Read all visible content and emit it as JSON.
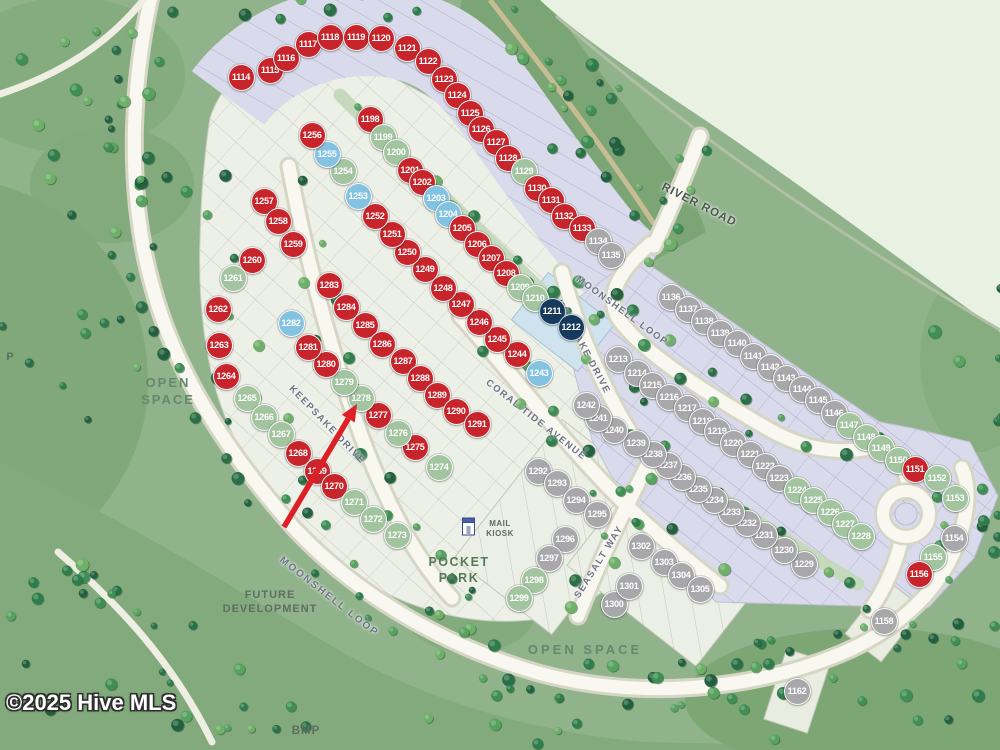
{
  "watermark": "©2025 Hive MLS",
  "map": {
    "status_colors": {
      "r": "#c7252b",
      "g": "#a2c5a0",
      "b": "#84c2e2",
      "n": "#16395c",
      "y": "#a8a8ab"
    },
    "street_labels": [
      {
        "id": "river-road",
        "text": "RIVER ROAD",
        "x": 699,
        "y": 205,
        "rot": 27,
        "size": 11.5,
        "ls": 1,
        "color": "#4c564c"
      },
      {
        "id": "moonshell-loop-ne",
        "text": "MOONSHELL LOOP",
        "x": 622,
        "y": 311,
        "rot": 36,
        "size": 9.5,
        "ls": 1.5,
        "color": "#6e7386"
      },
      {
        "id": "moonshell-loop-sw",
        "text": "MOONSHELL LOOP",
        "x": 329,
        "y": 597,
        "rot": 38,
        "size": 10,
        "ls": 2,
        "color": "#6e7386"
      },
      {
        "id": "keepsake-drive-e",
        "text": "KEEPSAKE DRIVE",
        "x": 583,
        "y": 347,
        "rot": 62,
        "size": 9.5,
        "ls": 1.5,
        "color": "#6e7386"
      },
      {
        "id": "keepsake-drive-w",
        "text": "KEEPSAKE DRIVE",
        "x": 327,
        "y": 425,
        "rot": 46,
        "size": 9.5,
        "ls": 1.5,
        "color": "#6e7386"
      },
      {
        "id": "coral-tide-avenue",
        "text": "CORAL TIDE AVENUE",
        "x": 536,
        "y": 420,
        "rot": 38,
        "size": 9.5,
        "ls": 1.5,
        "color": "#6e7386"
      },
      {
        "id": "seasalt-way",
        "text": "SEASALT WAY",
        "x": 599,
        "y": 562,
        "rot": -58,
        "size": 9.5,
        "ls": 1.5,
        "color": "#6e7386"
      }
    ],
    "area_labels": [
      {
        "id": "open-space-left",
        "lines": [
          "OPEN",
          "SPACE"
        ],
        "x": 168,
        "y": 375,
        "size": 13,
        "ls": 2,
        "color": "#66876b"
      },
      {
        "id": "open-space-bottom",
        "lines": [
          "OPEN SPACE"
        ],
        "x": 585,
        "y": 642,
        "size": 13,
        "ls": 3,
        "color": "#66876b"
      },
      {
        "id": "future-development",
        "lines": [
          "FUTURE",
          "DEVELOPMENT"
        ],
        "x": 270,
        "y": 588,
        "size": 11,
        "ls": 1,
        "color": "#5e6e60"
      },
      {
        "id": "pocket-park",
        "lines": [
          "POCKET",
          "PARK"
        ],
        "x": 459,
        "y": 554,
        "size": 12.5,
        "ls": 1.5,
        "color": "#567a58"
      },
      {
        "id": "bmp",
        "lines": [
          "BMP"
        ],
        "x": 306,
        "y": 724,
        "size": 11.5,
        "ls": 1,
        "color": "#5e6e60"
      },
      {
        "id": "p-partial",
        "lines": [
          "P"
        ],
        "x": 10,
        "y": 350,
        "size": 11,
        "ls": 0,
        "color": "#5e6e60"
      },
      {
        "id": "mail-kiosk",
        "lines": [
          "MAIL",
          "KIOSK"
        ],
        "x": 500,
        "y": 519,
        "size": 8,
        "ls": 0.5,
        "color": "#5c6c66"
      }
    ],
    "annotations": {
      "arrow": {
        "x1": 284,
        "y1": 527,
        "x2": 357,
        "y2": 404,
        "color": "#dd1f26"
      }
    },
    "lots": [
      {
        "n": "1114",
        "x": 241,
        "y": 77,
        "c": "r"
      },
      {
        "n": "1115",
        "x": 270,
        "y": 70,
        "c": "r"
      },
      {
        "n": "1116",
        "x": 286,
        "y": 58,
        "c": "r"
      },
      {
        "n": "1117",
        "x": 308,
        "y": 44,
        "c": "r"
      },
      {
        "n": "1118",
        "x": 330,
        "y": 37,
        "c": "r"
      },
      {
        "n": "1119",
        "x": 356,
        "y": 37,
        "c": "r"
      },
      {
        "n": "1120",
        "x": 381,
        "y": 38,
        "c": "r"
      },
      {
        "n": "1121",
        "x": 407,
        "y": 48,
        "c": "r"
      },
      {
        "n": "1122",
        "x": 428,
        "y": 61,
        "c": "r"
      },
      {
        "n": "1123",
        "x": 444,
        "y": 79,
        "c": "r"
      },
      {
        "n": "1124",
        "x": 457,
        "y": 95,
        "c": "r"
      },
      {
        "n": "1125",
        "x": 470,
        "y": 113,
        "c": "r"
      },
      {
        "n": "1126",
        "x": 481,
        "y": 129,
        "c": "r"
      },
      {
        "n": "1127",
        "x": 496,
        "y": 142,
        "c": "r"
      },
      {
        "n": "1128",
        "x": 508,
        "y": 158,
        "c": "r"
      },
      {
        "n": "1129",
        "x": 524,
        "y": 171,
        "c": "g"
      },
      {
        "n": "1130",
        "x": 537,
        "y": 188,
        "c": "r"
      },
      {
        "n": "1131",
        "x": 551,
        "y": 200,
        "c": "r"
      },
      {
        "n": "1132",
        "x": 564,
        "y": 216,
        "c": "r"
      },
      {
        "n": "1133",
        "x": 582,
        "y": 228,
        "c": "r"
      },
      {
        "n": "1134",
        "x": 598,
        "y": 241,
        "c": "y"
      },
      {
        "n": "1135",
        "x": 611,
        "y": 255,
        "c": "y"
      },
      {
        "n": "1136",
        "x": 671,
        "y": 297,
        "c": "y"
      },
      {
        "n": "1137",
        "x": 688,
        "y": 309,
        "c": "y"
      },
      {
        "n": "1138",
        "x": 704,
        "y": 321,
        "c": "y"
      },
      {
        "n": "1139",
        "x": 720,
        "y": 333,
        "c": "y"
      },
      {
        "n": "1140",
        "x": 737,
        "y": 343,
        "c": "y"
      },
      {
        "n": "1141",
        "x": 753,
        "y": 356,
        "c": "y"
      },
      {
        "n": "1142",
        "x": 770,
        "y": 367,
        "c": "y"
      },
      {
        "n": "1143",
        "x": 786,
        "y": 378,
        "c": "y"
      },
      {
        "n": "1144",
        "x": 802,
        "y": 389,
        "c": "y"
      },
      {
        "n": "1145",
        "x": 818,
        "y": 400,
        "c": "y"
      },
      {
        "n": "1146",
        "x": 834,
        "y": 413,
        "c": "y"
      },
      {
        "n": "1147",
        "x": 849,
        "y": 425,
        "c": "g"
      },
      {
        "n": "1148",
        "x": 866,
        "y": 437,
        "c": "g"
      },
      {
        "n": "1149",
        "x": 881,
        "y": 448,
        "c": "g"
      },
      {
        "n": "1150",
        "x": 898,
        "y": 460,
        "c": "g"
      },
      {
        "n": "1151",
        "x": 915,
        "y": 469,
        "c": "r"
      },
      {
        "n": "1152",
        "x": 937,
        "y": 478,
        "c": "g"
      },
      {
        "n": "1153",
        "x": 955,
        "y": 498,
        "c": "g"
      },
      {
        "n": "1154",
        "x": 954,
        "y": 538,
        "c": "y"
      },
      {
        "n": "1155",
        "x": 933,
        "y": 557,
        "c": "g"
      },
      {
        "n": "1156",
        "x": 919,
        "y": 574,
        "c": "r"
      },
      {
        "n": "1158",
        "x": 884,
        "y": 621,
        "c": "y"
      },
      {
        "n": "1162",
        "x": 797,
        "y": 691,
        "c": "y"
      },
      {
        "n": "1198",
        "x": 370,
        "y": 119,
        "c": "r"
      },
      {
        "n": "1199",
        "x": 383,
        "y": 137,
        "c": "g"
      },
      {
        "n": "1200",
        "x": 396,
        "y": 152,
        "c": "g"
      },
      {
        "n": "1201",
        "x": 410,
        "y": 170,
        "c": "r"
      },
      {
        "n": "1202",
        "x": 422,
        "y": 182,
        "c": "r"
      },
      {
        "n": "1203",
        "x": 436,
        "y": 198,
        "c": "b"
      },
      {
        "n": "1204",
        "x": 448,
        "y": 214,
        "c": "b"
      },
      {
        "n": "1205",
        "x": 462,
        "y": 228,
        "c": "r"
      },
      {
        "n": "1206",
        "x": 477,
        "y": 244,
        "c": "r"
      },
      {
        "n": "1207",
        "x": 491,
        "y": 258,
        "c": "r"
      },
      {
        "n": "1208",
        "x": 506,
        "y": 273,
        "c": "r"
      },
      {
        "n": "1209",
        "x": 520,
        "y": 287,
        "c": "g"
      },
      {
        "n": "1210",
        "x": 535,
        "y": 298,
        "c": "g"
      },
      {
        "n": "1211",
        "x": 552,
        "y": 311,
        "c": "n"
      },
      {
        "n": "1212",
        "x": 571,
        "y": 327,
        "c": "n"
      },
      {
        "n": "1213",
        "x": 618,
        "y": 359,
        "c": "y"
      },
      {
        "n": "1214",
        "x": 637,
        "y": 373,
        "c": "y"
      },
      {
        "n": "1215",
        "x": 652,
        "y": 385,
        "c": "y"
      },
      {
        "n": "1216",
        "x": 669,
        "y": 397,
        "c": "y"
      },
      {
        "n": "1217",
        "x": 687,
        "y": 408,
        "c": "y"
      },
      {
        "n": "1218",
        "x": 702,
        "y": 421,
        "c": "y"
      },
      {
        "n": "1219",
        "x": 717,
        "y": 431,
        "c": "y"
      },
      {
        "n": "1220",
        "x": 733,
        "y": 443,
        "c": "y"
      },
      {
        "n": "1221",
        "x": 750,
        "y": 454,
        "c": "y"
      },
      {
        "n": "1222",
        "x": 765,
        "y": 466,
        "c": "y"
      },
      {
        "n": "1223",
        "x": 779,
        "y": 478,
        "c": "y"
      },
      {
        "n": "1224",
        "x": 797,
        "y": 490,
        "c": "g"
      },
      {
        "n": "1225",
        "x": 813,
        "y": 500,
        "c": "g"
      },
      {
        "n": "1226",
        "x": 830,
        "y": 512,
        "c": "g"
      },
      {
        "n": "1227",
        "x": 845,
        "y": 524,
        "c": "g"
      },
      {
        "n": "1228",
        "x": 861,
        "y": 536,
        "c": "g"
      },
      {
        "n": "1229",
        "x": 804,
        "y": 564,
        "c": "y"
      },
      {
        "n": "1230",
        "x": 784,
        "y": 550,
        "c": "y"
      },
      {
        "n": "1231",
        "x": 764,
        "y": 535,
        "c": "y"
      },
      {
        "n": "1232",
        "x": 747,
        "y": 523,
        "c": "y"
      },
      {
        "n": "1233",
        "x": 731,
        "y": 512,
        "c": "y"
      },
      {
        "n": "1234",
        "x": 714,
        "y": 500,
        "c": "y"
      },
      {
        "n": "1235",
        "x": 698,
        "y": 489,
        "c": "y"
      },
      {
        "n": "1236",
        "x": 682,
        "y": 477,
        "c": "y"
      },
      {
        "n": "1237",
        "x": 668,
        "y": 465,
        "c": "y"
      },
      {
        "n": "1238",
        "x": 653,
        "y": 454,
        "c": "y"
      },
      {
        "n": "1239",
        "x": 636,
        "y": 443,
        "c": "y"
      },
      {
        "n": "1240",
        "x": 614,
        "y": 430,
        "c": "y"
      },
      {
        "n": "1241",
        "x": 598,
        "y": 418,
        "c": "y"
      },
      {
        "n": "1242",
        "x": 586,
        "y": 405,
        "c": "y"
      },
      {
        "n": "1243",
        "x": 539,
        "y": 373,
        "c": "b"
      },
      {
        "n": "1244",
        "x": 517,
        "y": 354,
        "c": "r"
      },
      {
        "n": "1245",
        "x": 497,
        "y": 339,
        "c": "r"
      },
      {
        "n": "1246",
        "x": 479,
        "y": 322,
        "c": "r"
      },
      {
        "n": "1247",
        "x": 461,
        "y": 304,
        "c": "r"
      },
      {
        "n": "1248",
        "x": 443,
        "y": 288,
        "c": "r"
      },
      {
        "n": "1249",
        "x": 425,
        "y": 269,
        "c": "r"
      },
      {
        "n": "1250",
        "x": 407,
        "y": 252,
        "c": "r"
      },
      {
        "n": "1251",
        "x": 392,
        "y": 234,
        "c": "r"
      },
      {
        "n": "1252",
        "x": 375,
        "y": 216,
        "c": "r"
      },
      {
        "n": "1253",
        "x": 358,
        "y": 196,
        "c": "b"
      },
      {
        "n": "1254",
        "x": 343,
        "y": 171,
        "c": "g"
      },
      {
        "n": "1255",
        "x": 327,
        "y": 154,
        "c": "b"
      },
      {
        "n": "1256",
        "x": 312,
        "y": 135,
        "c": "r"
      },
      {
        "n": "1257",
        "x": 264,
        "y": 201,
        "c": "r"
      },
      {
        "n": "1258",
        "x": 278,
        "y": 221,
        "c": "r"
      },
      {
        "n": "1259",
        "x": 293,
        "y": 244,
        "c": "r"
      },
      {
        "n": "1260",
        "x": 252,
        "y": 260,
        "c": "r"
      },
      {
        "n": "1261",
        "x": 233,
        "y": 278,
        "c": "g"
      },
      {
        "n": "1262",
        "x": 218,
        "y": 309,
        "c": "r"
      },
      {
        "n": "1263",
        "x": 219,
        "y": 345,
        "c": "r"
      },
      {
        "n": "1264",
        "x": 226,
        "y": 376,
        "c": "r"
      },
      {
        "n": "1265",
        "x": 247,
        "y": 398,
        "c": "g"
      },
      {
        "n": "1266",
        "x": 264,
        "y": 417,
        "c": "g"
      },
      {
        "n": "1267",
        "x": 281,
        "y": 434,
        "c": "g"
      },
      {
        "n": "1268",
        "x": 298,
        "y": 453,
        "c": "r"
      },
      {
        "n": "1269",
        "x": 317,
        "y": 471,
        "c": "r"
      },
      {
        "n": "1270",
        "x": 334,
        "y": 486,
        "c": "r"
      },
      {
        "n": "1271",
        "x": 354,
        "y": 502,
        "c": "g"
      },
      {
        "n": "1272",
        "x": 373,
        "y": 519,
        "c": "g"
      },
      {
        "n": "1273",
        "x": 397,
        "y": 535,
        "c": "g"
      },
      {
        "n": "1274",
        "x": 439,
        "y": 467,
        "c": "g"
      },
      {
        "n": "1275",
        "x": 415,
        "y": 447,
        "c": "r"
      },
      {
        "n": "1276",
        "x": 398,
        "y": 433,
        "c": "g"
      },
      {
        "n": "1277",
        "x": 378,
        "y": 415,
        "c": "r"
      },
      {
        "n": "1278",
        "x": 361,
        "y": 398,
        "c": "g"
      },
      {
        "n": "1279",
        "x": 344,
        "y": 382,
        "c": "g"
      },
      {
        "n": "1280",
        "x": 326,
        "y": 364,
        "c": "r"
      },
      {
        "n": "1281",
        "x": 308,
        "y": 347,
        "c": "r"
      },
      {
        "n": "1282",
        "x": 291,
        "y": 323,
        "c": "b"
      },
      {
        "n": "1283",
        "x": 329,
        "y": 285,
        "c": "r"
      },
      {
        "n": "1284",
        "x": 346,
        "y": 307,
        "c": "r"
      },
      {
        "n": "1285",
        "x": 365,
        "y": 325,
        "c": "r"
      },
      {
        "n": "1286",
        "x": 382,
        "y": 344,
        "c": "r"
      },
      {
        "n": "1287",
        "x": 403,
        "y": 361,
        "c": "r"
      },
      {
        "n": "1288",
        "x": 420,
        "y": 378,
        "c": "r"
      },
      {
        "n": "1289",
        "x": 437,
        "y": 395,
        "c": "r"
      },
      {
        "n": "1290",
        "x": 456,
        "y": 411,
        "c": "r"
      },
      {
        "n": "1291",
        "x": 477,
        "y": 424,
        "c": "r"
      },
      {
        "n": "1292",
        "x": 538,
        "y": 471,
        "c": "y"
      },
      {
        "n": "1293",
        "x": 557,
        "y": 483,
        "c": "y"
      },
      {
        "n": "1294",
        "x": 576,
        "y": 500,
        "c": "y"
      },
      {
        "n": "1295",
        "x": 597,
        "y": 514,
        "c": "y"
      },
      {
        "n": "1296",
        "x": 565,
        "y": 539,
        "c": "y"
      },
      {
        "n": "1297",
        "x": 549,
        "y": 558,
        "c": "y"
      },
      {
        "n": "1298",
        "x": 534,
        "y": 580,
        "c": "g"
      },
      {
        "n": "1299",
        "x": 519,
        "y": 598,
        "c": "g"
      },
      {
        "n": "1300",
        "x": 614,
        "y": 604,
        "c": "y"
      },
      {
        "n": "1301",
        "x": 629,
        "y": 586,
        "c": "y"
      },
      {
        "n": "1302",
        "x": 641,
        "y": 546,
        "c": "y"
      },
      {
        "n": "1303",
        "x": 664,
        "y": 562,
        "c": "y"
      },
      {
        "n": "1304",
        "x": 681,
        "y": 575,
        "c": "y"
      },
      {
        "n": "1305",
        "x": 700,
        "y": 589,
        "c": "y"
      }
    ]
  }
}
